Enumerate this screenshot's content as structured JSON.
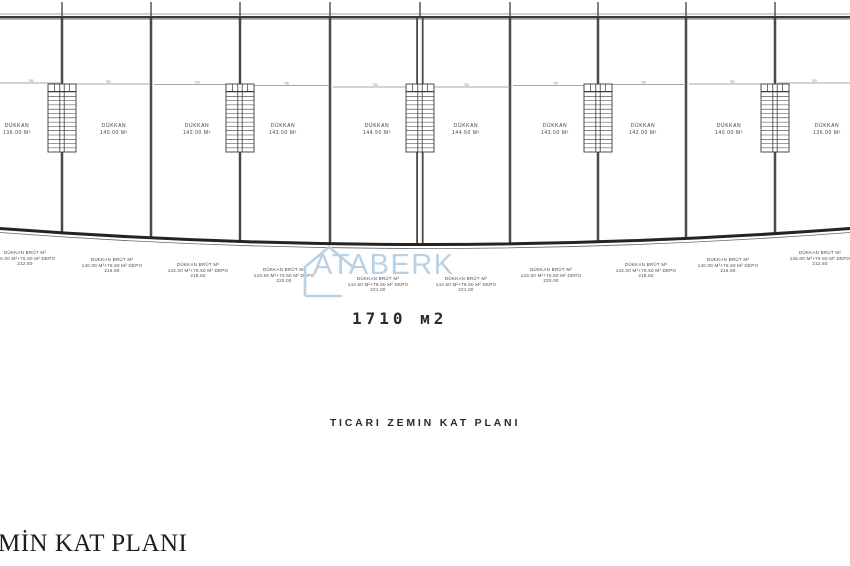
{
  "texts": {
    "plan_title": "TICARI ZEMIN KAT PLANI",
    "total_area": "1710 м2",
    "bottom_caption": "MİN KAT PLANI"
  },
  "watermark": {
    "text": "ATABERK",
    "color": "#b7cfe4"
  },
  "colors": {
    "wall_dark": "#3a3a3a",
    "divider": "#4a4a4a",
    "thin_line": "#8a8a8a",
    "front_wall": "#242424",
    "label_text": "#3d3d3d",
    "watermark_blue": "#b7cfe4"
  },
  "dim_tick_label": "750",
  "shops": [
    {
      "name": "DÜKKAN",
      "area": "136.00 M²",
      "brut_lines": [
        "DÜKKAN BRÜT M²",
        "136.00 M²+76.50 M² DEPO",
        "212.50"
      ]
    },
    {
      "name": "DÜKKAN",
      "area": "140.00 M²",
      "brut_lines": [
        "DÜKKAN BRÜT M²",
        "140.00 M²+76.50 M² DEPO",
        "216.50"
      ]
    },
    {
      "name": "DÜKKAN",
      "area": "142.00 M²",
      "brut_lines": [
        "DÜKKAN BRÜT M²",
        "142.00 M²+76.50 M² DEPO",
        "218.50"
      ]
    },
    {
      "name": "DÜKKAN",
      "area": "143.50 M²",
      "brut_lines": [
        "DÜKKAN BRÜT M²",
        "143.50 M²+76.50 M² DEPO",
        "220.00"
      ]
    },
    {
      "name": "DÜKKAN",
      "area": "144.50 M²",
      "brut_lines": [
        "DÜKKAN BRÜT M²",
        "144.50 M²+76.50 M² DEPO",
        "221.00"
      ]
    },
    {
      "name": "DÜKKAN",
      "area": "144.50 M²",
      "brut_lines": [
        "DÜKKAN BRÜT M²",
        "144.50 M²+76.50 M² DEPO",
        "221.00"
      ]
    },
    {
      "name": "DÜKKAN",
      "area": "143.50 M²",
      "brut_lines": [
        "DÜKKAN BRÜT M²",
        "143.50 M²+76.50 M² DEPO",
        "220.00"
      ]
    },
    {
      "name": "DÜKKAN",
      "area": "142.00 M²",
      "brut_lines": [
        "DÜKKAN BRÜT M²",
        "142.00 M²+76.50 M² DEPO",
        "218.50"
      ]
    },
    {
      "name": "DÜKKAN",
      "area": "140.00 M²",
      "brut_lines": [
        "DÜKKAN BRÜT M²",
        "140.00 M²+76.50 M² DEPO",
        "216.50"
      ]
    },
    {
      "name": "DÜKKAN",
      "area": "136.00 M²",
      "brut_lines": [
        "DÜKKAN BRÜT M²",
        "136.00 M²+76.50 M² DEPO",
        "212.50"
      ]
    }
  ]
}
